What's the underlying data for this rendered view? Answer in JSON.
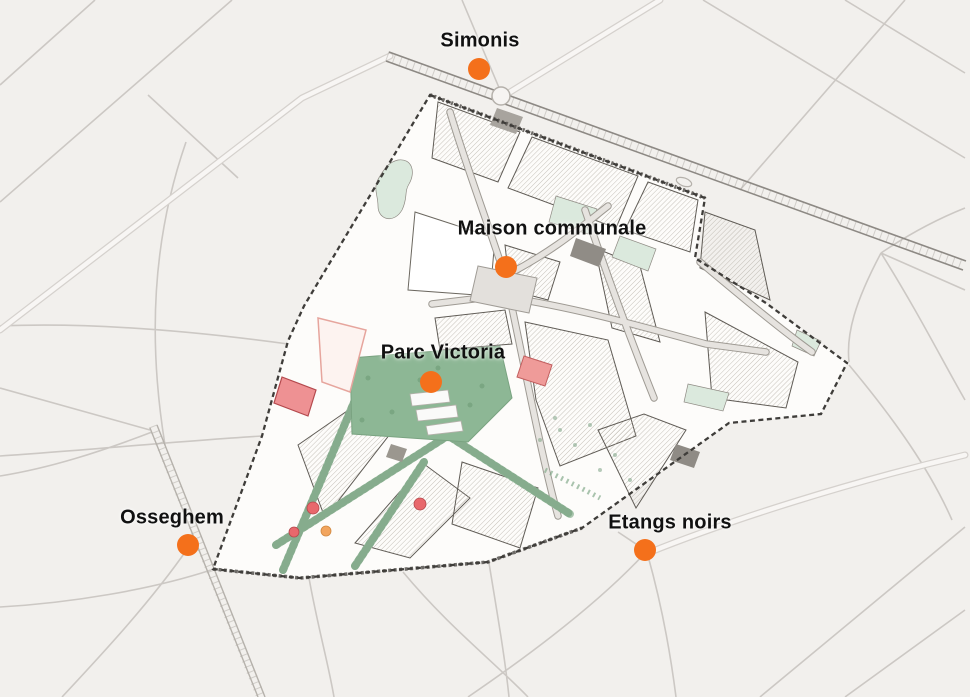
{
  "stations": [
    {
      "label": "Simonis",
      "dot": {
        "x": 479,
        "y": 69
      },
      "label_pos": {
        "x": 480,
        "y": 41
      }
    },
    {
      "label": "Maison communale",
      "dot": {
        "x": 506,
        "y": 267
      },
      "label_pos": {
        "x": 552,
        "y": 229
      }
    },
    {
      "label": "Parc Victoria",
      "dot": {
        "x": 431,
        "y": 382
      },
      "label_pos": {
        "x": 443,
        "y": 353
      }
    },
    {
      "label": "Osseghem",
      "dot": {
        "x": 188,
        "y": 545
      },
      "label_pos": {
        "x": 172,
        "y": 518
      }
    },
    {
      "label": "Etangs noirs",
      "dot": {
        "x": 645,
        "y": 550
      },
      "label_pos": {
        "x": 670,
        "y": 523
      }
    }
  ],
  "marker": {
    "color": "#f4701b",
    "diameter_px": 22
  },
  "label_style": {
    "color": "#111111"
  },
  "map_colors": {
    "background": "#f2f0ed",
    "district_fill": "#fdfcfa",
    "park_green": "#8db795",
    "street_green": "#abc7af",
    "courtyard_green": "#dbe9dd",
    "building_red": "#ee9193",
    "building_orange": "#f2a55e",
    "boundary": "#3f3d3a"
  }
}
